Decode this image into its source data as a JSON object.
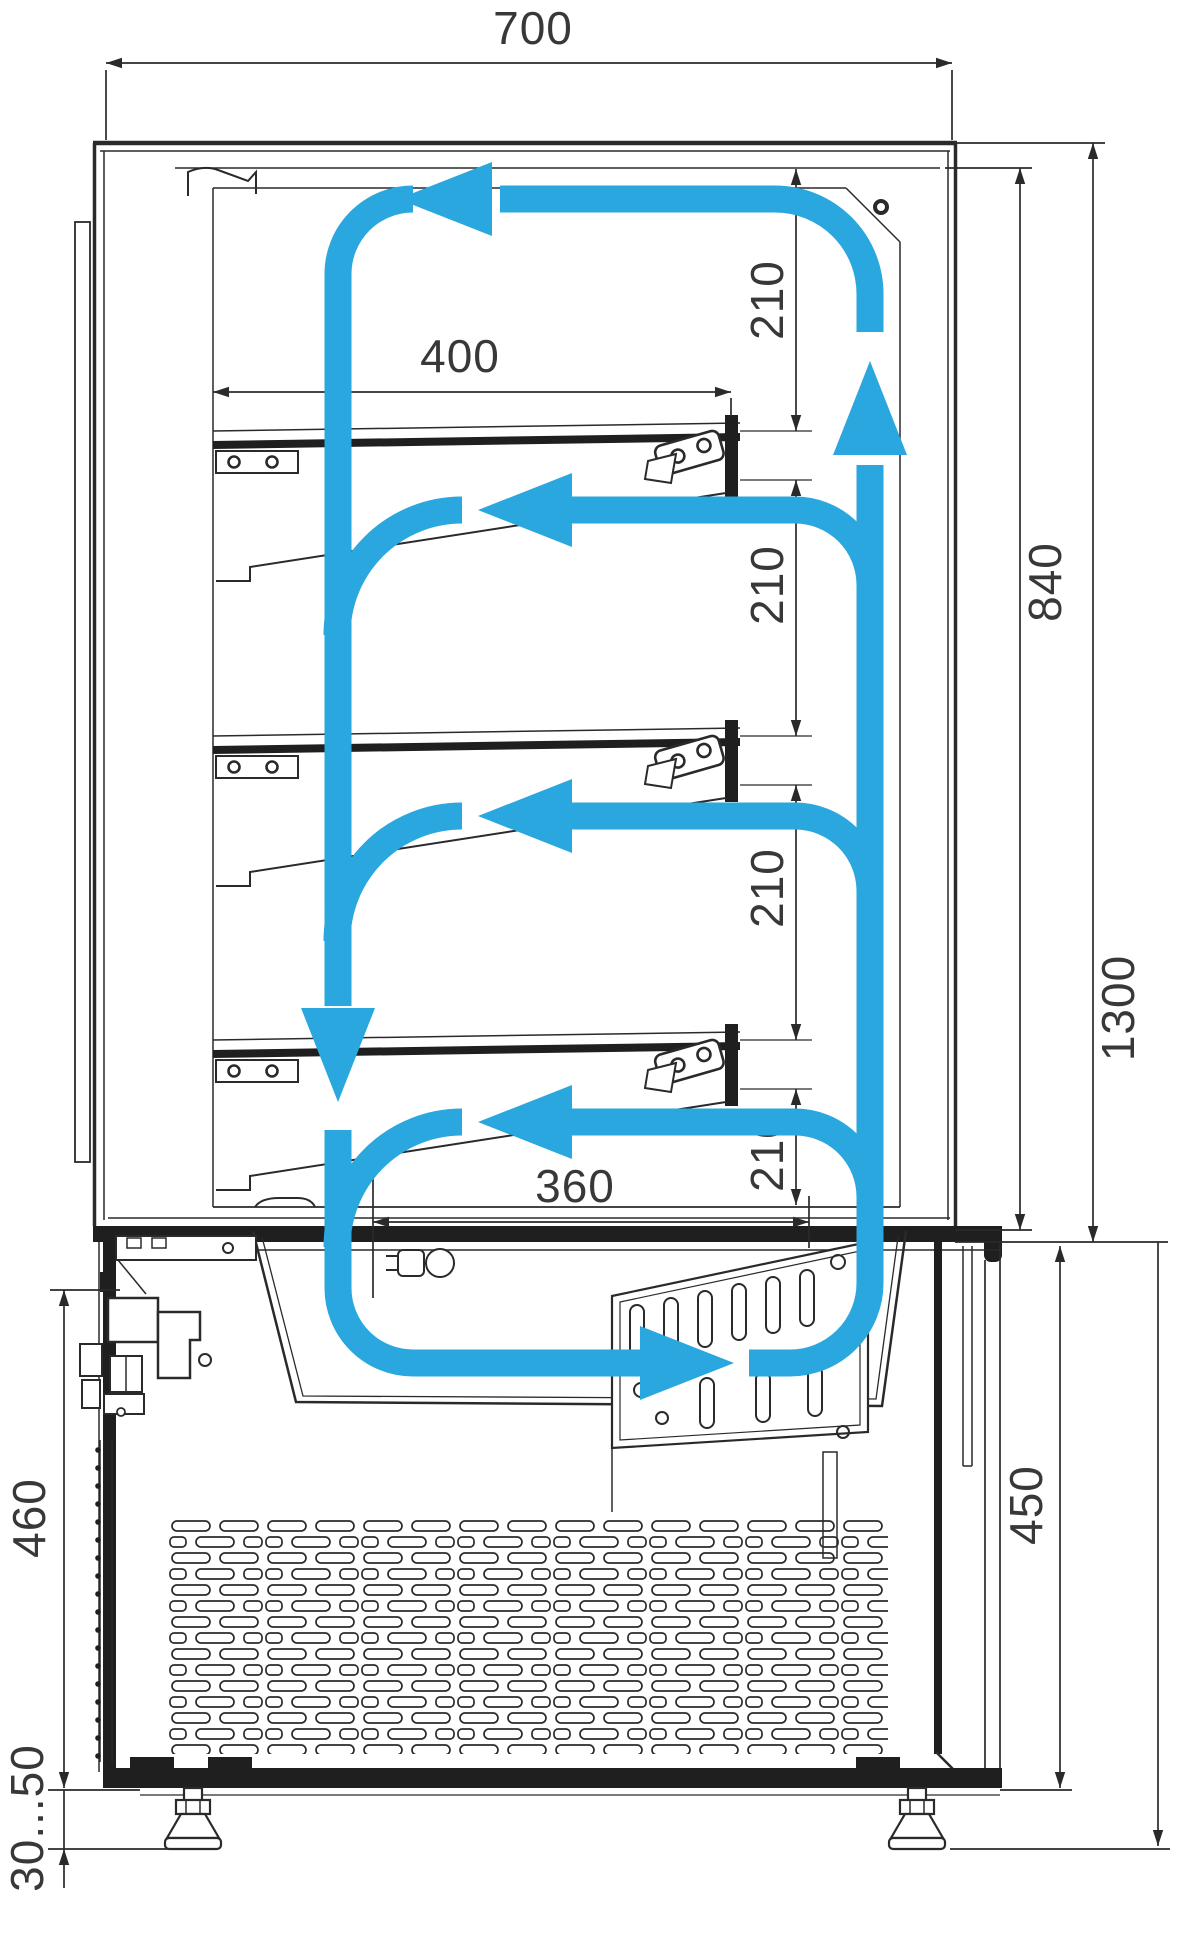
{
  "drawing": {
    "kind": "refrigerated display case side section with air circulation",
    "units": "mm"
  },
  "colors": {
    "airflow": "#29a7de",
    "line": "#2a2a2a",
    "thick": "#1f1f1f",
    "text": "#383838",
    "background": "#ffffff"
  },
  "dims": {
    "w700": {
      "label": "700"
    },
    "d400": {
      "label": "400"
    },
    "d360": {
      "label": "360"
    },
    "p210_1": {
      "label": "210"
    },
    "p210_2": {
      "label": "210"
    },
    "p210_3": {
      "label": "210"
    },
    "p210_4": {
      "label": "210"
    },
    "h840": {
      "label": "840"
    },
    "h1300": {
      "label": "1300"
    },
    "h460": {
      "label": "460"
    },
    "h450": {
      "label": "450"
    },
    "feet": {
      "label": "30...50"
    }
  }
}
